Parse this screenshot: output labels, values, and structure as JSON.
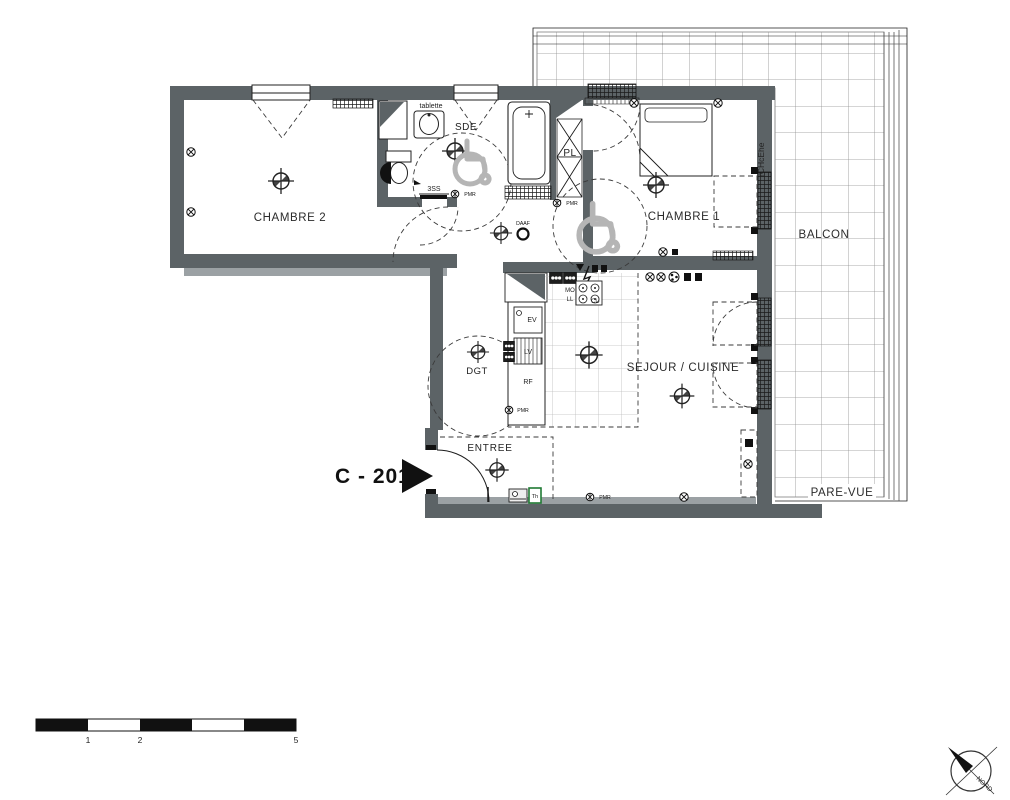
{
  "drawing": {
    "unit_label": "C - 201",
    "rooms": {
      "chambre2": "CHAMBRE 2",
      "sde": "SDE",
      "pl": "PL",
      "chambre1": "CHAMBRE 1",
      "balcon": "BALCON",
      "sejour_cuisine": "SEJOUR / CUISINE",
      "dgt": "DGT",
      "entree": "ENTREE",
      "pare_vue": "PARE-VUE"
    },
    "fixtures": {
      "tablette": "tablette",
      "shower_drain": "3SS",
      "pmr": "PMR",
      "daaf": "DAAF",
      "micro_onde": "MO",
      "lave_linge": "LL",
      "evier": "EV",
      "lave_vaisselle": "LV",
      "refrigerateur": "RF",
      "cuisson": "CU",
      "thermostat": "Th"
    },
    "compass": {
      "north": "NORD"
    },
    "wall_annotation": "rCHcEhe",
    "scale_bar": {
      "labels": [
        "1",
        "2",
        "5"
      ]
    },
    "colors": {
      "wall": "#5c6366",
      "wall_light": "#9ba1a4",
      "line": "#1c1c1c",
      "balcony_grid": "#8f8f8f",
      "tile_grid": "#bcbcbc",
      "thermostat_green": "#1f7a33",
      "paper": "#ffffff"
    }
  }
}
